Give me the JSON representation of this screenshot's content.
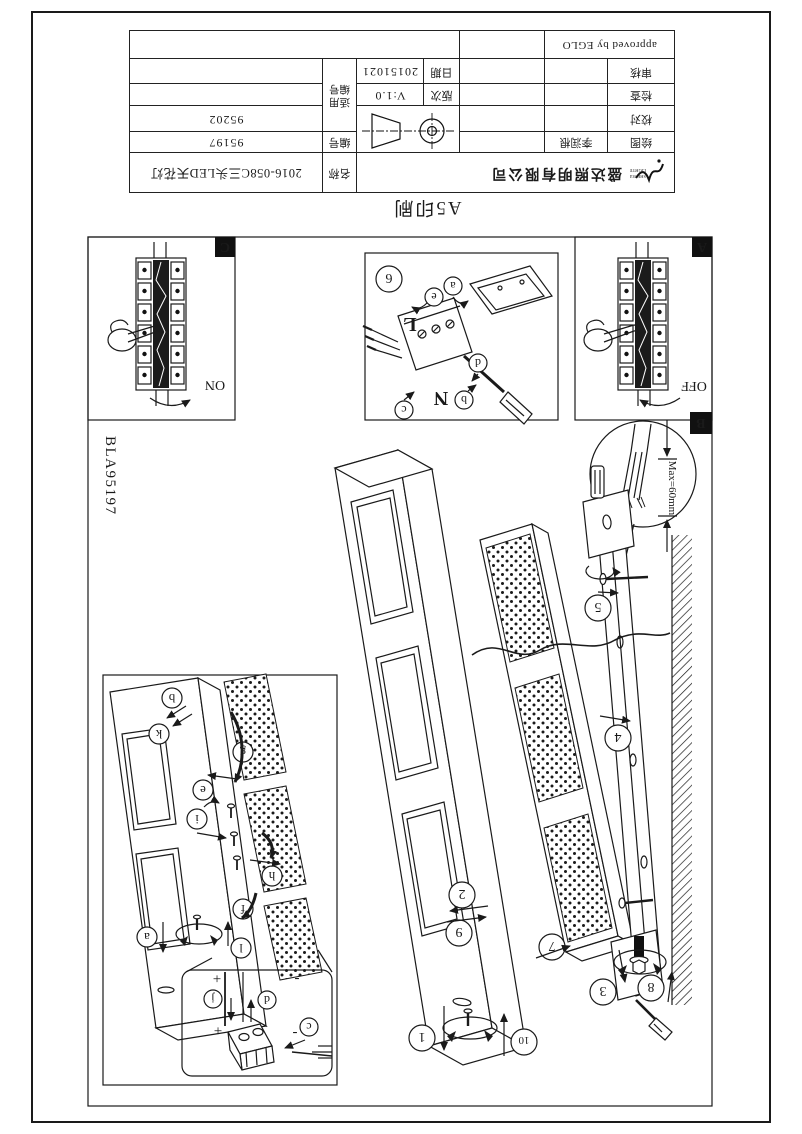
{
  "page": {
    "print_label": "A5印刷",
    "drawing_code": "BLA95197"
  },
  "title_block": {
    "company_name": "盛达照明有限公司",
    "logo": {
      "line1": "SHENGDA",
      "line2": "LIGHTING"
    },
    "product_name_label": "名称",
    "product_name": "2016-058C三头LED天花灯",
    "number_label": "编号",
    "number": "95197",
    "applicable_label": "适用编号",
    "applicable_number": "95202",
    "version_label": "版次",
    "version": "V:1.0",
    "date_label": "日期",
    "date": "20151021",
    "sign_rows": {
      "draw": "绘图",
      "drafter": "李润根",
      "proof": "校对",
      "check": "检查",
      "review": "审核"
    },
    "approved": "approved by EGLO"
  },
  "diagram": {
    "panel_a": "A",
    "panel_b": "B",
    "panel_c": "C",
    "switch_on": "ON",
    "switch_off": "OFF",
    "max_dimension": "Max=60mm",
    "live": "L",
    "neutral": "N",
    "plus": "+",
    "minus": "-",
    "steps": {
      "s1": "1",
      "s2": "2",
      "s3": "3",
      "s4": "4",
      "s5": "5",
      "s6": "6",
      "s7": "7",
      "s8": "8",
      "s9": "9",
      "s10": "10"
    },
    "substeps": {
      "a": "a",
      "b": "b",
      "c": "c",
      "d": "d",
      "e": "e",
      "f": "f",
      "g": "g",
      "h": "h",
      "i": "i",
      "j": "j",
      "k": "k",
      "l": "l"
    }
  }
}
